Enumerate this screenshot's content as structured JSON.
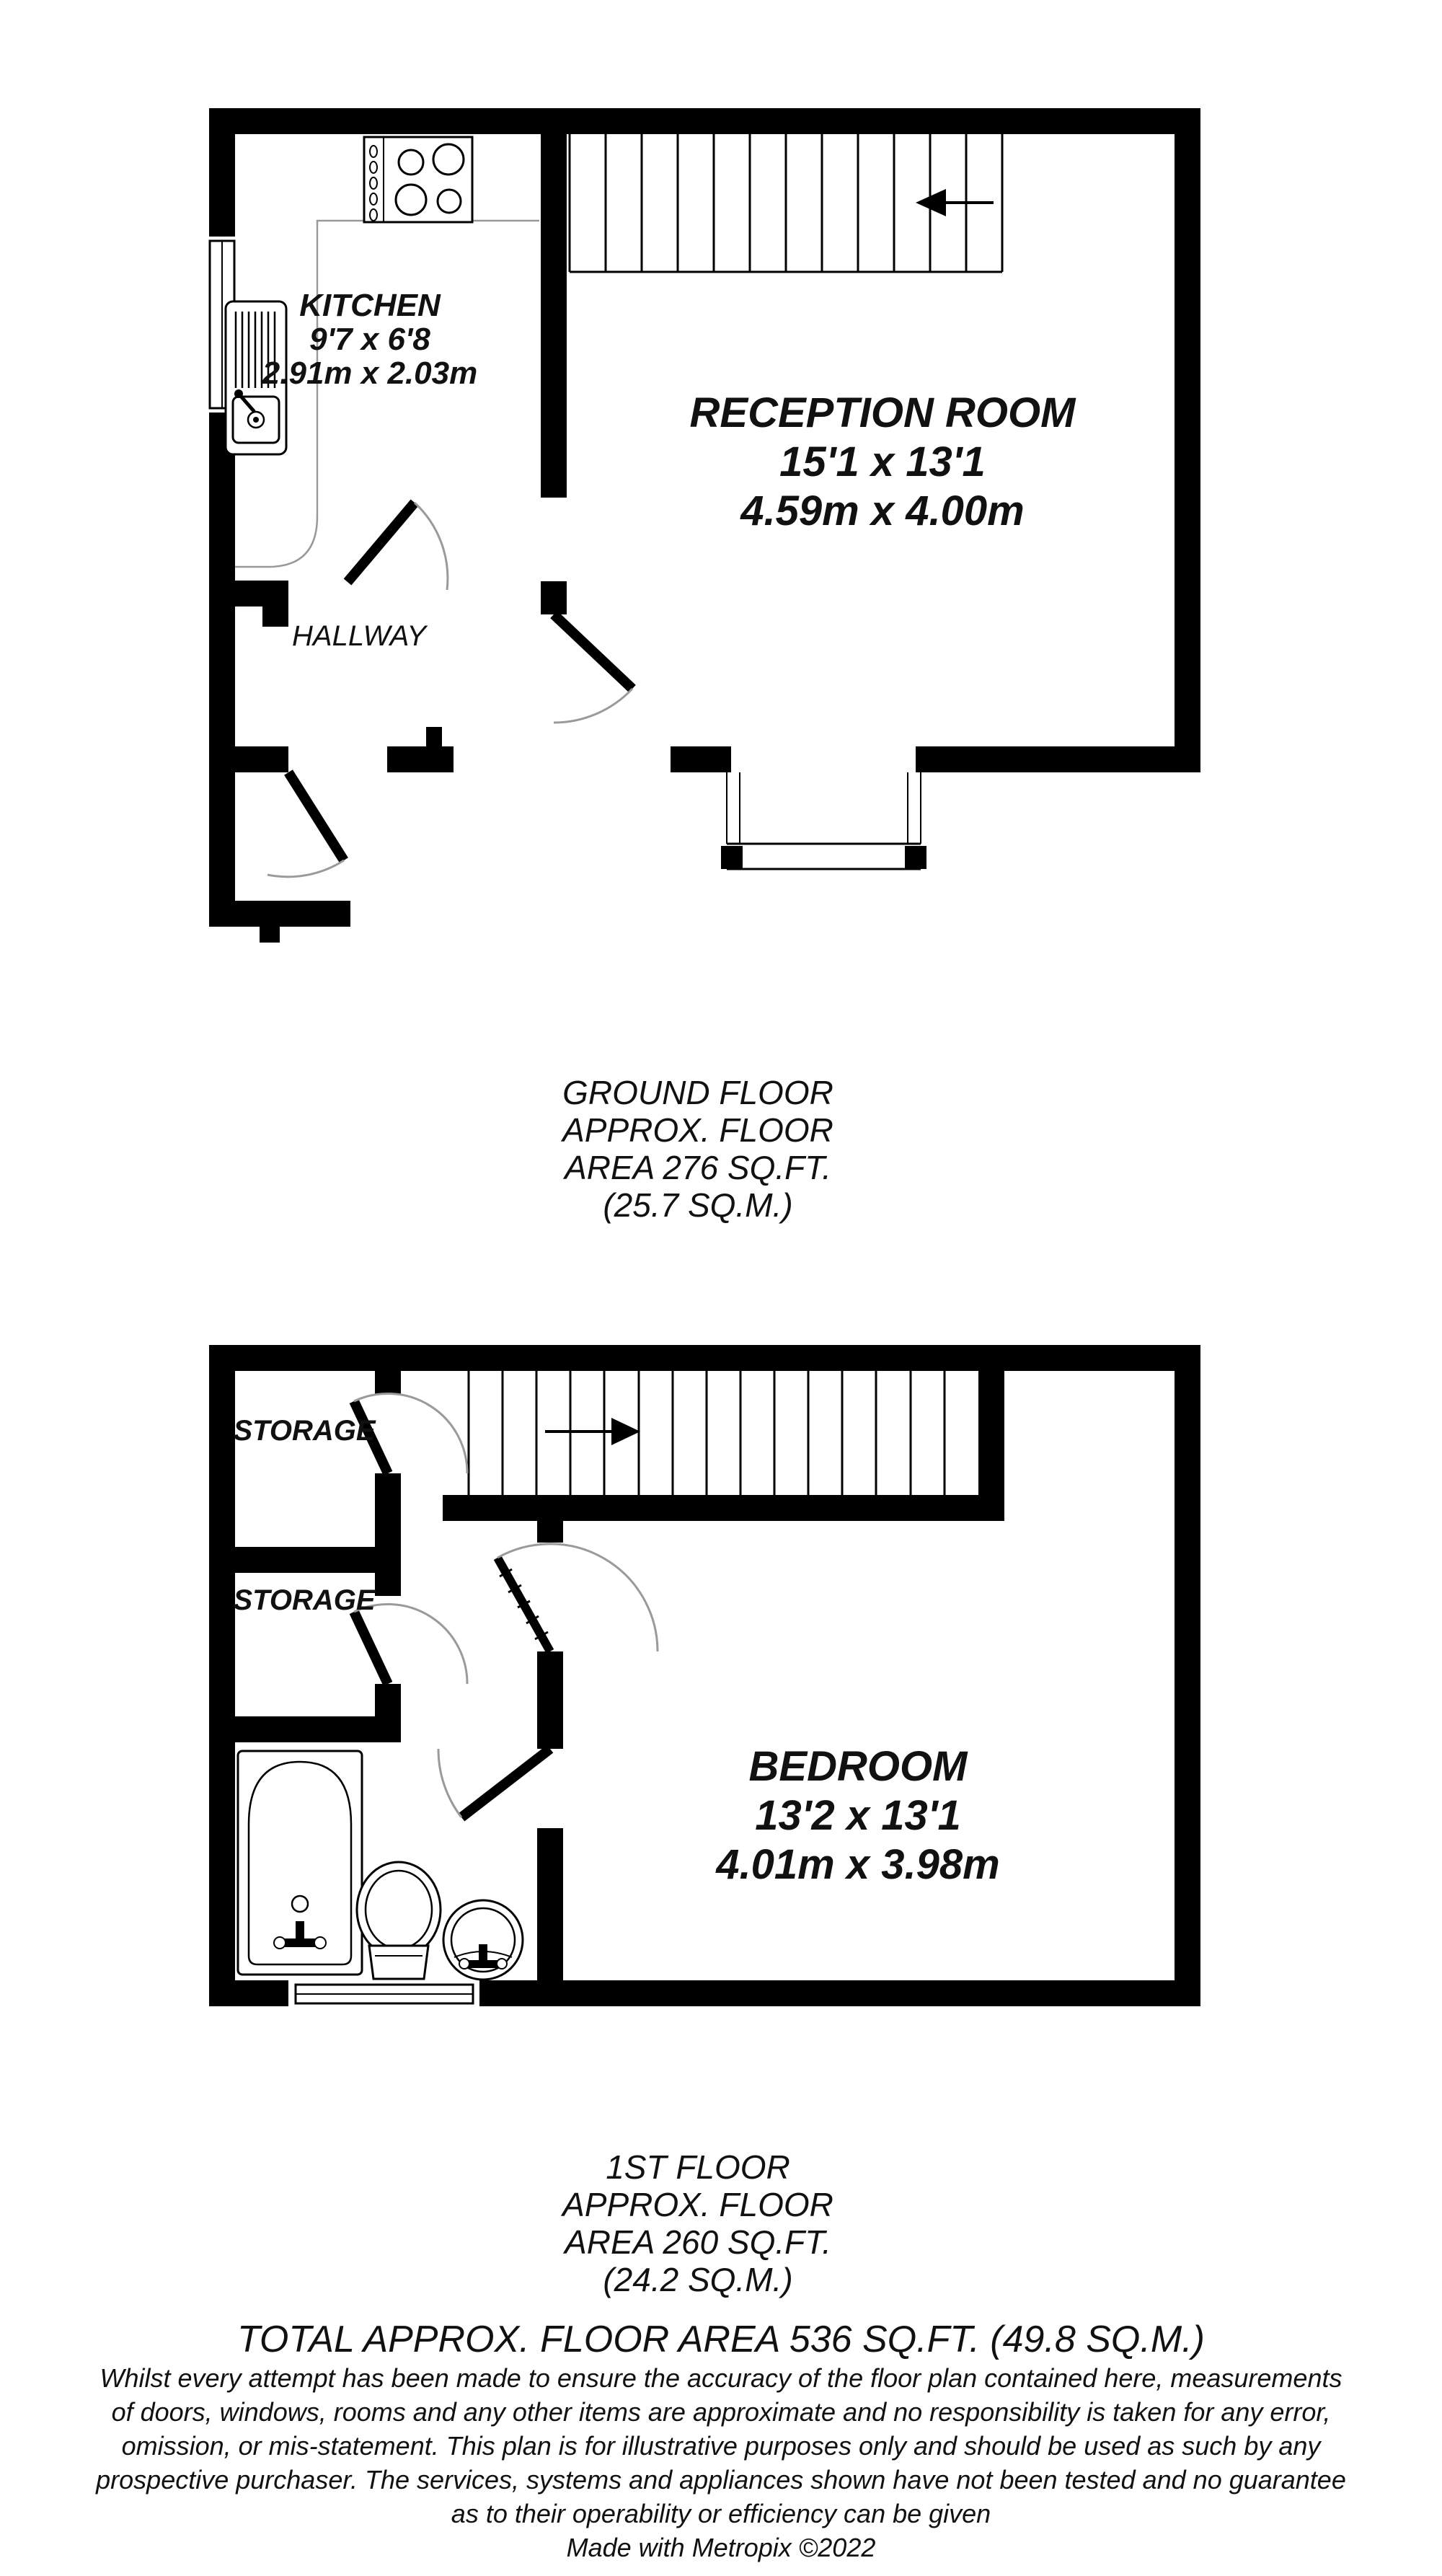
{
  "floorplan": {
    "ground_floor": {
      "kitchen": {
        "name": "KITCHEN",
        "imperial": "9'7 x 6'8",
        "metric": "2.91m x 2.03m"
      },
      "reception": {
        "name": "RECEPTION ROOM",
        "imperial": "15'1 x 13'1",
        "metric": "4.59m x 4.00m"
      },
      "hallway": {
        "name": "HALLWAY"
      },
      "caption": [
        "GROUND FLOOR",
        "APPROX. FLOOR",
        "AREA 276 SQ.FT.",
        "(25.7 SQ.M.)"
      ]
    },
    "first_floor": {
      "storage_top": {
        "name": "STORAGE"
      },
      "storage_bottom": {
        "name": "STORAGE"
      },
      "bedroom": {
        "name": "BEDROOM",
        "imperial": "13'2 x 13'1",
        "metric": "4.01m x 3.98m"
      },
      "caption": [
        "1ST FLOOR",
        "APPROX. FLOOR",
        "AREA 260 SQ.FT.",
        "(24.2 SQ.M.)"
      ]
    },
    "total": "TOTAL APPROX. FLOOR AREA 536 SQ.FT. (49.8 SQ.M.)",
    "disclaimer": [
      "Whilst every attempt has been made to ensure the accuracy of the floor plan contained here, measurements",
      "of doors, windows, rooms and any other items are approximate and no responsibility is taken for any error,",
      "omission, or mis-statement. This plan is for illustrative purposes only and should be used as such by any",
      "prospective purchaser. The services, systems and appliances shown have not been tested and no guarantee",
      "as to their operability or efficiency can be given"
    ],
    "credit": "Made with Metropix ©2022",
    "colors": {
      "wall": "#000000",
      "door_arc": "#9a9a9a",
      "counter": "#999999",
      "text": "#111111",
      "background": "#ffffff"
    }
  }
}
